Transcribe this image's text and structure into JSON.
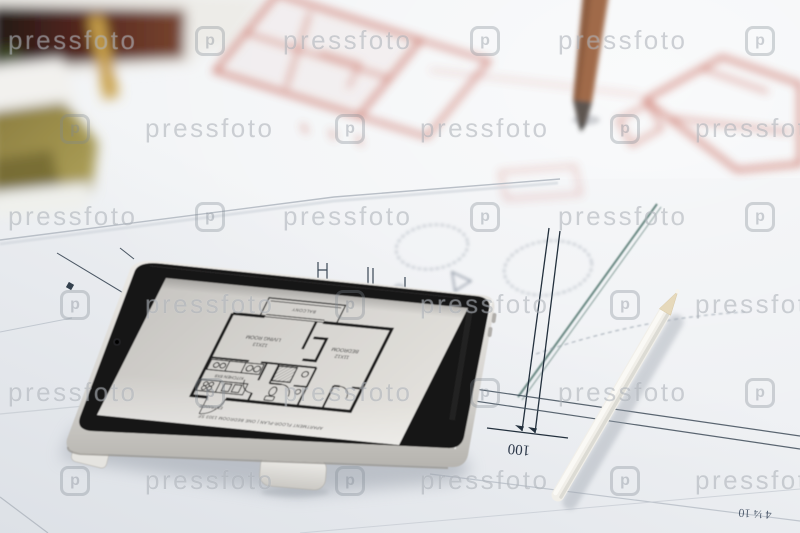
{
  "watermark": {
    "text": "pressfoto",
    "logo_letter": "p"
  },
  "tablet_screen": {
    "floor_plan": {
      "balcony": "BALCONY",
      "living_room": "LIVING ROOM",
      "living_room_size": "12X13",
      "bedroom": "BEDROOM",
      "bedroom_size": "11X12",
      "kitchen": "KITCHEN 8X8",
      "entrance": "ENTRANCE",
      "caption": "APARTMENT FLOOR-PLAN | ONE BEDROOM 1303 SF"
    }
  },
  "blueprint": {
    "dimension_label": "100",
    "note_label": "4 ¼ 10"
  },
  "colors": {
    "paper": "#eef0f3",
    "tablet_bezel": "#161514",
    "tablet_body": "#d8d6d2",
    "screen": "#d6d4d0",
    "red_pencil_sketch": "#c2584a",
    "teal_ink": "#355f56",
    "blueprint_ink": "#23303d",
    "wood_pencil": "#a06a48",
    "white_pencil": "#f1efe9"
  }
}
